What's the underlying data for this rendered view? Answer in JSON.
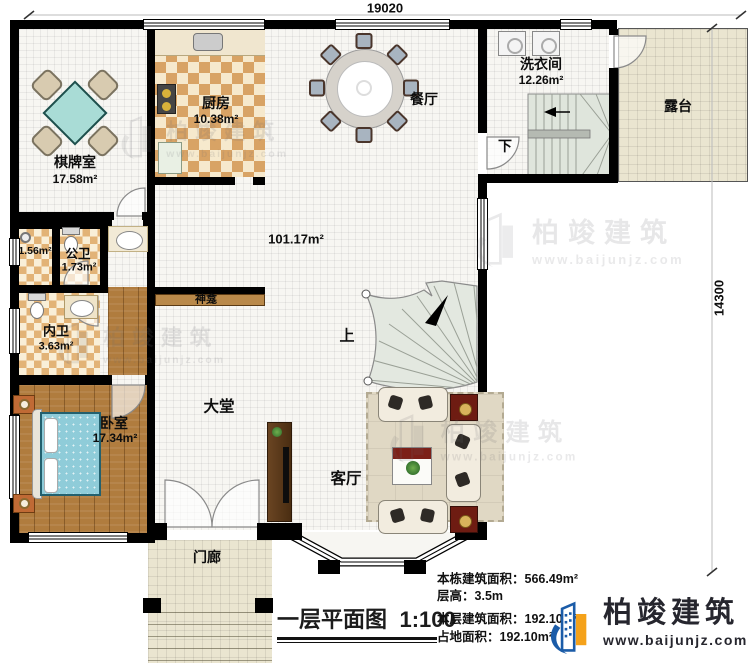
{
  "dimensions": {
    "width": "19020",
    "height": "14300"
  },
  "rooms": {
    "chess": {
      "name": "棋牌室",
      "area": "17.58m²"
    },
    "kitchen": {
      "name": "厨房",
      "area": "10.38m²"
    },
    "dining": {
      "name": "餐厅"
    },
    "laundry": {
      "name": "洗衣间",
      "area": "12.26m²"
    },
    "terrace": {
      "name": "露台"
    },
    "hall": {
      "area": "101.17m²"
    },
    "lobby": {
      "name": "大堂"
    },
    "living": {
      "name": "客厅"
    },
    "bedroom": {
      "name": "卧室",
      "area": "17.34m²"
    },
    "public_wc": {
      "name": "公卫",
      "area": "1.73m²"
    },
    "shower": {
      "area": "1.56m²"
    },
    "ensuite": {
      "name": "内卫",
      "area": "3.63m²"
    },
    "porch": {
      "name": "门廊"
    },
    "shrine": {
      "name": "神龛"
    },
    "stairs_up": "上",
    "stairs_down": "下"
  },
  "title": {
    "text": "一层平面图",
    "scale": "1:100"
  },
  "stats": {
    "building_area": {
      "label": "本栋建筑面积：",
      "value": "566.49m²"
    },
    "floor_height": {
      "label": "层高：",
      "value": "3.5m"
    },
    "floor_area": {
      "label": "本层建筑面积：",
      "value": "192.10m²"
    },
    "footprint": {
      "label": "占地面积：",
      "value": "192.10m²"
    }
  },
  "logo": {
    "name": "柏竣建筑",
    "website": "www.baijunjz.com"
  },
  "watermark": {
    "name": "柏竣建筑",
    "website": "www.baijunjz.com"
  },
  "colors": {
    "logo_blue": "#1b5ca8",
    "logo_orange": "#f5a21a",
    "wall": "#000000",
    "stair": "#dfe5dc",
    "bed": "#8fccd9",
    "wood": "#b07c3e"
  }
}
